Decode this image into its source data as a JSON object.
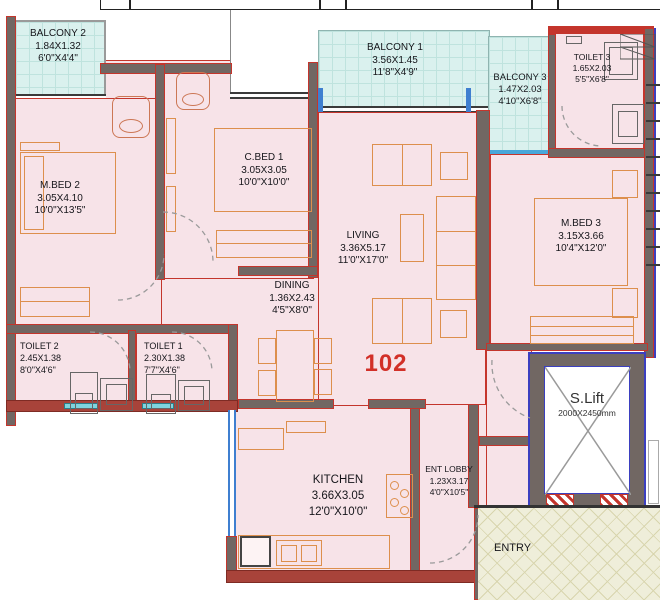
{
  "unit_number": "102",
  "rooms": {
    "balcony2": {
      "name": "BALCONY 2",
      "metric": "1.84X1.32",
      "imperial": "6'0\"X4'4\""
    },
    "balcony1": {
      "name": "BALCONY 1",
      "metric": "3.56X1.45",
      "imperial": "11'8\"X4'9\""
    },
    "balcony3": {
      "name": "BALCONY 3",
      "metric": "1.47X2.03",
      "imperial": "4'10\"X6'8\""
    },
    "toilet3": {
      "name": "TOILET 3",
      "metric": "1.65X2.03",
      "imperial": "5'5\"X6'8\""
    },
    "mbed2": {
      "name": "M.BED 2",
      "metric": "3.05X4.10",
      "imperial": "10'0\"X13'5\""
    },
    "cbed1": {
      "name": "C.BED 1",
      "metric": "3.05X3.05",
      "imperial": "10'0\"X10'0\""
    },
    "living": {
      "name": "LIVING",
      "metric": "3.36X5.17",
      "imperial": "11'0\"X17'0\""
    },
    "dining": {
      "name": "DINING",
      "metric": "1.36X2.43",
      "imperial": "4'5\"X8'0\""
    },
    "mbed3": {
      "name": "M.BED 3",
      "metric": "3.15X3.66",
      "imperial": "10'4\"X12'0\""
    },
    "toilet2": {
      "name": "TOILET 2",
      "metric": "2.45X1.38",
      "imperial": "8'0\"X4'6\""
    },
    "toilet1": {
      "name": "TOILET 1",
      "metric": "2.30X1.38",
      "imperial": "7'7\"X4'6\""
    },
    "kitchen": {
      "name": "KITCHEN",
      "metric": "3.66X3.05",
      "imperial": "12'0\"X10'0\""
    },
    "ent_lobby": {
      "name": "ENT LOBBY",
      "metric": "1.23X3.17",
      "imperial": "4'0\"X10'5\""
    },
    "lift": {
      "name": "S.Lift",
      "metric": "2000X2450mm"
    },
    "entry": {
      "name": "ENTRY"
    }
  },
  "colors": {
    "wall_outline_red": "#c4352c",
    "wall_gray": "#716763",
    "wall_maroon": "#a8433a",
    "room_fill_pink": "#f7e3e8",
    "balcony_fill_cyan": "#daf1ee",
    "entry_fill_beige": "#efeeda",
    "lift_border_blue": "#3b3fc0",
    "window_blue": "#4a90d9",
    "furniture_orange": "#dd8f4d",
    "unit_number_red": "#d23028"
  }
}
